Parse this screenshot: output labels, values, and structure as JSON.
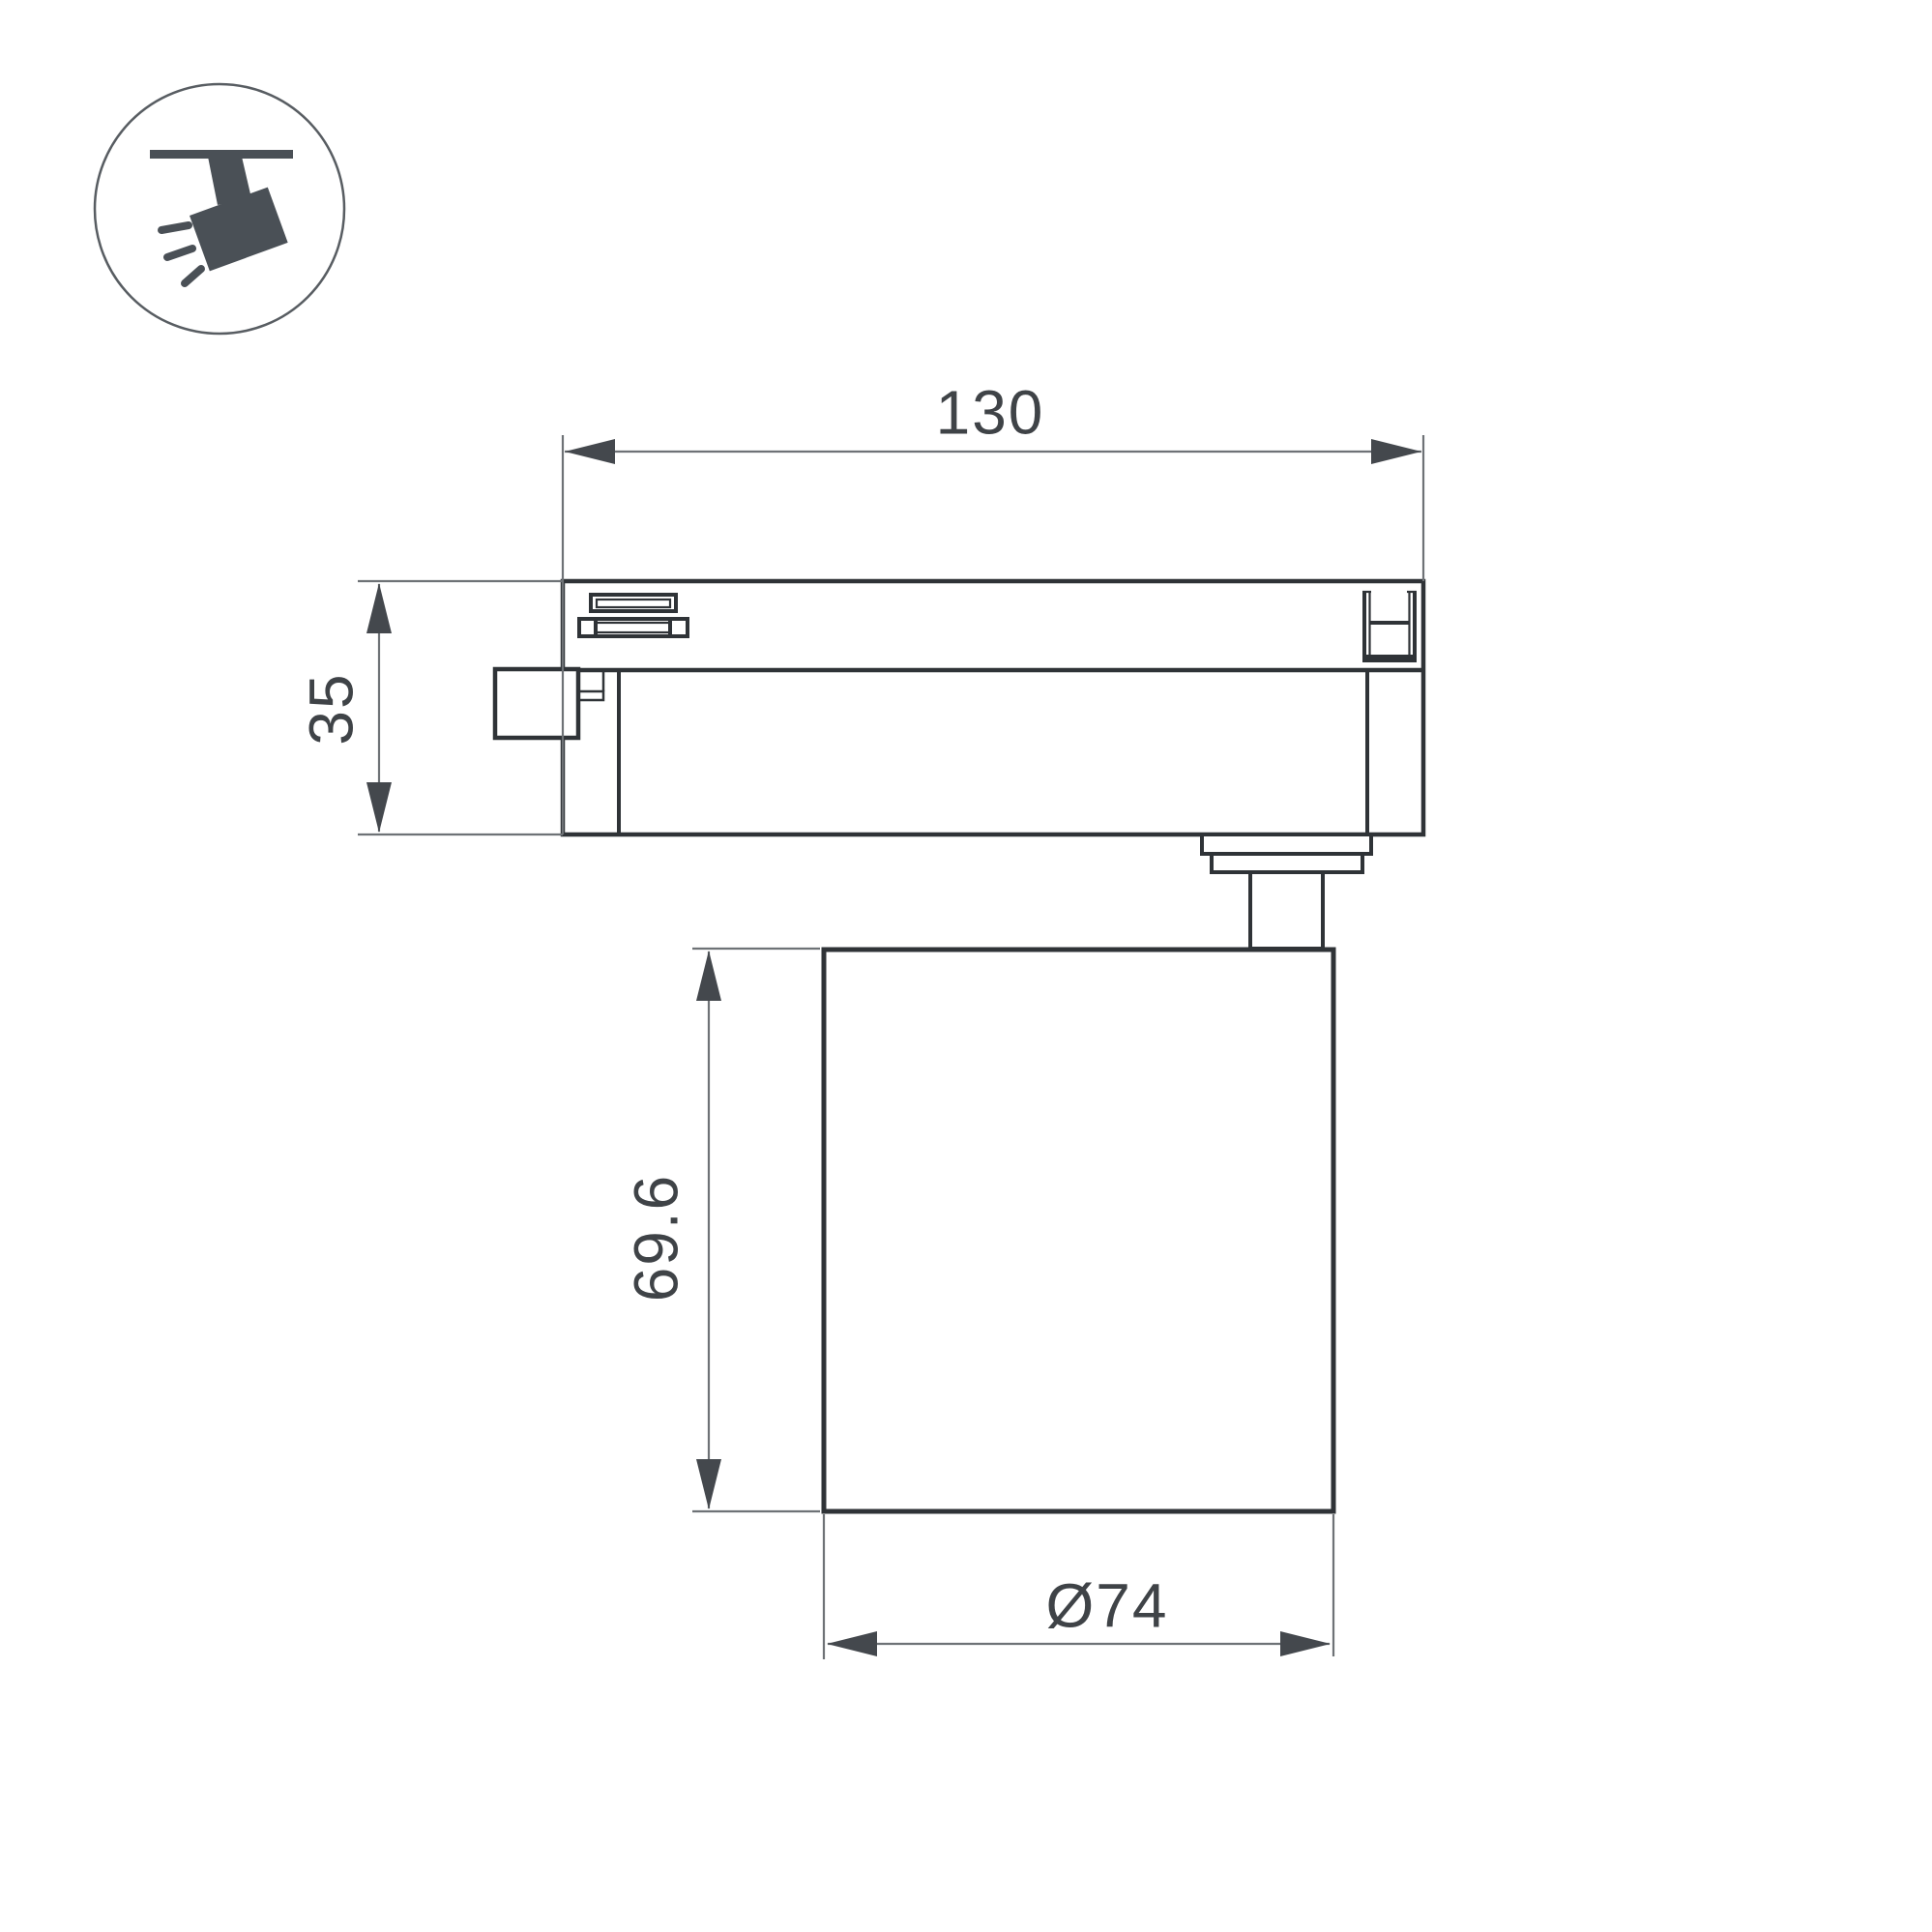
{
  "drawing": {
    "type": "technical-dimension-drawing",
    "subject": "track-mounted spotlight, side view",
    "labels": {
      "track_width": "130",
      "track_height": "35",
      "body_height": "69.6",
      "body_diameter": "Ø74"
    },
    "icon": {
      "name": "track-spotlight-icon",
      "description": "circular badge with ceiling track and tilted spotlight emitting rays"
    }
  },
  "colors": {
    "background": "#ffffff",
    "outline": "#2f3337",
    "detail": "#34383c",
    "dimension_line": "#6e7276",
    "dimension_text": "#3f4347",
    "arrow": "#44484d",
    "icon_glyph": "#4a5056",
    "icon_ring": "#585d62"
  }
}
